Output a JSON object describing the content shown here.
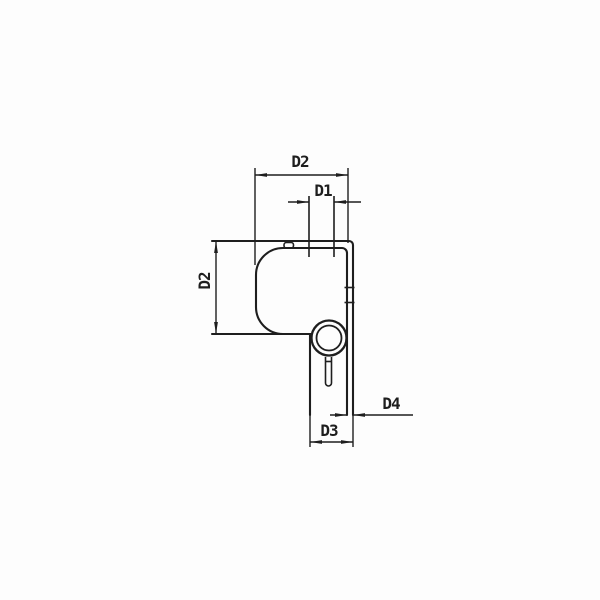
{
  "drawing": {
    "type": "technical-dimension-drawing",
    "labels": {
      "d1": "D1",
      "d2_top": "D2",
      "d2_left": "D2",
      "d3": "D3",
      "d4": "D4"
    },
    "colors": {
      "line": "#1e1e1e",
      "background": "#fdfdfd"
    }
  }
}
